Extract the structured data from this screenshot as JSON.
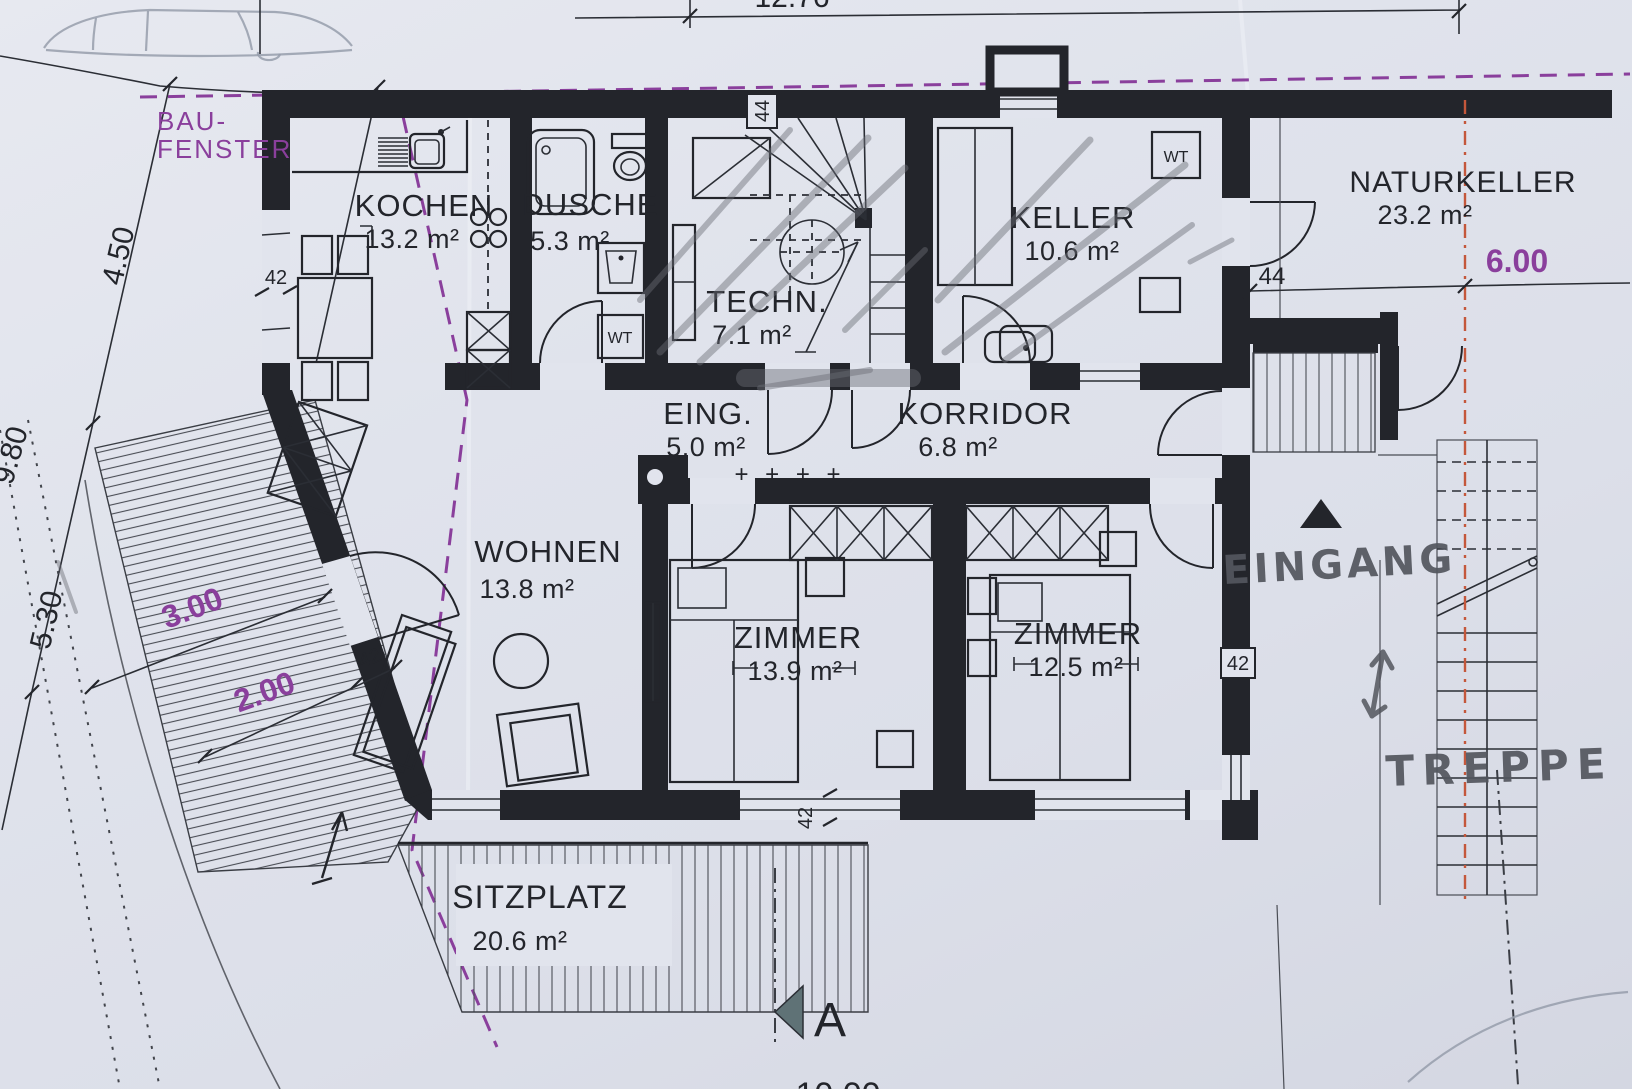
{
  "plan": {
    "title": "Erdgeschoss Grundriss (floor plan scan)",
    "rooms": [
      {
        "id": "kochen",
        "name": "KOCHEN",
        "area": "13.2 m²"
      },
      {
        "id": "dusche",
        "name": "DUSCHE",
        "area": "5.3 m²"
      },
      {
        "id": "techn",
        "name": "TECHN.",
        "area": "7.1 m²"
      },
      {
        "id": "keller",
        "name": "KELLER",
        "area": "10.6 m²"
      },
      {
        "id": "naturkeller",
        "name": "NATURKELLER",
        "area": "23.2 m²"
      },
      {
        "id": "eing",
        "name": "EING.",
        "area": "5.0 m²"
      },
      {
        "id": "korridor",
        "name": "KORRIDOR",
        "area": "6.8 m²"
      },
      {
        "id": "wohnen",
        "name": "WOHNEN",
        "area": "13.8 m²"
      },
      {
        "id": "zimmer1",
        "name": "ZIMMER",
        "area": "13.9 m²"
      },
      {
        "id": "zimmer2",
        "name": "ZIMMER",
        "area": "12.5 m²"
      },
      {
        "id": "sitzplatz",
        "name": "SITZPLATZ",
        "area": "20.6 m²"
      }
    ],
    "annotations": {
      "bau_fenster_line1": "BAU-",
      "bau_fenster_line2": "FENSTER",
      "eingang": "EINGANG",
      "treppe": "TREPPE",
      "section_letter": "A",
      "wt_dusche": "WT",
      "wt_keller": "WT",
      "door_sill_marks": "+ + + +"
    },
    "dimensions": {
      "d_450": "4.50",
      "d_980": "9.80",
      "d_530": "5.30",
      "d_300": "3.00",
      "d_200": "2.00",
      "d_600": "6.00",
      "wall_42_left": "42",
      "wall_42_terrace": "42",
      "wall_42_bottom": "42",
      "wall_42_right": "42",
      "wall_44_top": "44",
      "wall_44_naturkeller": "44",
      "d_top_partial": "12.76",
      "d_bottom_partial": "10.00"
    },
    "colors": {
      "paper": "#e0e3ec",
      "ink": "#23252b",
      "purple": "#8a3f9c",
      "pencil": "#6a6d75",
      "red_dash": "#c4573b",
      "section_fill": "#5f7276",
      "faint_grey": "#979dab"
    }
  }
}
